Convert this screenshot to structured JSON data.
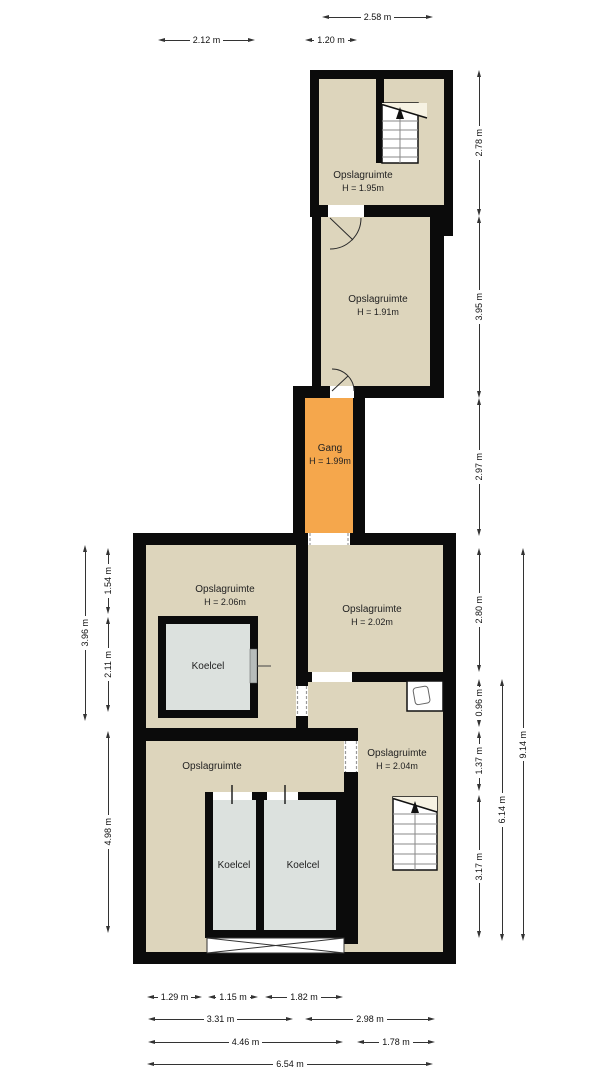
{
  "rooms": {
    "storage_top": {
      "name": "Opslagruimte",
      "height": "H = 1.95m"
    },
    "storage_mid": {
      "name": "Opslagruimte",
      "height": "H = 1.91m"
    },
    "gang": {
      "name": "Gang",
      "height": "H = 1.99m"
    },
    "storage_nw": {
      "name": "Opslagruimte",
      "height": "H = 2.06m"
    },
    "storage_ne": {
      "name": "Opslagruimte",
      "height": "H = 2.02m"
    },
    "koelcel_nw": {
      "name": "Koelcel"
    },
    "storage_se": {
      "name": "Opslagruimte",
      "height": "H = 2.04m"
    },
    "storage_sw": {
      "name": "Opslagruimte"
    },
    "koelcel_sw1": {
      "name": "Koelcel"
    },
    "koelcel_sw2": {
      "name": "Koelcel"
    }
  },
  "dims": {
    "t212": "2.12 m",
    "t258": "2.58 m",
    "t120": "1.20 m",
    "r278": "2.78 m",
    "r395": "3.95 m",
    "r297": "2.97 m",
    "r280": "2.80 m",
    "r096": "0.96 m",
    "r137": "1.37 m",
    "r317": "3.17 m",
    "v614": "6.14 m",
    "v914": "9.14 m",
    "l154": "1.54 m",
    "l211": "2.11 m",
    "l396": "3.96 m",
    "l498": "4.98 m",
    "b129": "1.29 m",
    "b115": "1.15 m",
    "b182": "1.82 m",
    "b331": "3.31 m",
    "b298": "2.98 m",
    "b446": "4.46 m",
    "b178": "1.78 m",
    "b654": "6.54 m"
  },
  "colors": {
    "wall": "#0b0b0b",
    "storage_fill": "#ddd5bc",
    "cold_room_fill": "#dce1de",
    "hallway_fill": "#f5a74c",
    "stair_landing_fill": "#f6f2e3",
    "background": "#ffffff"
  }
}
